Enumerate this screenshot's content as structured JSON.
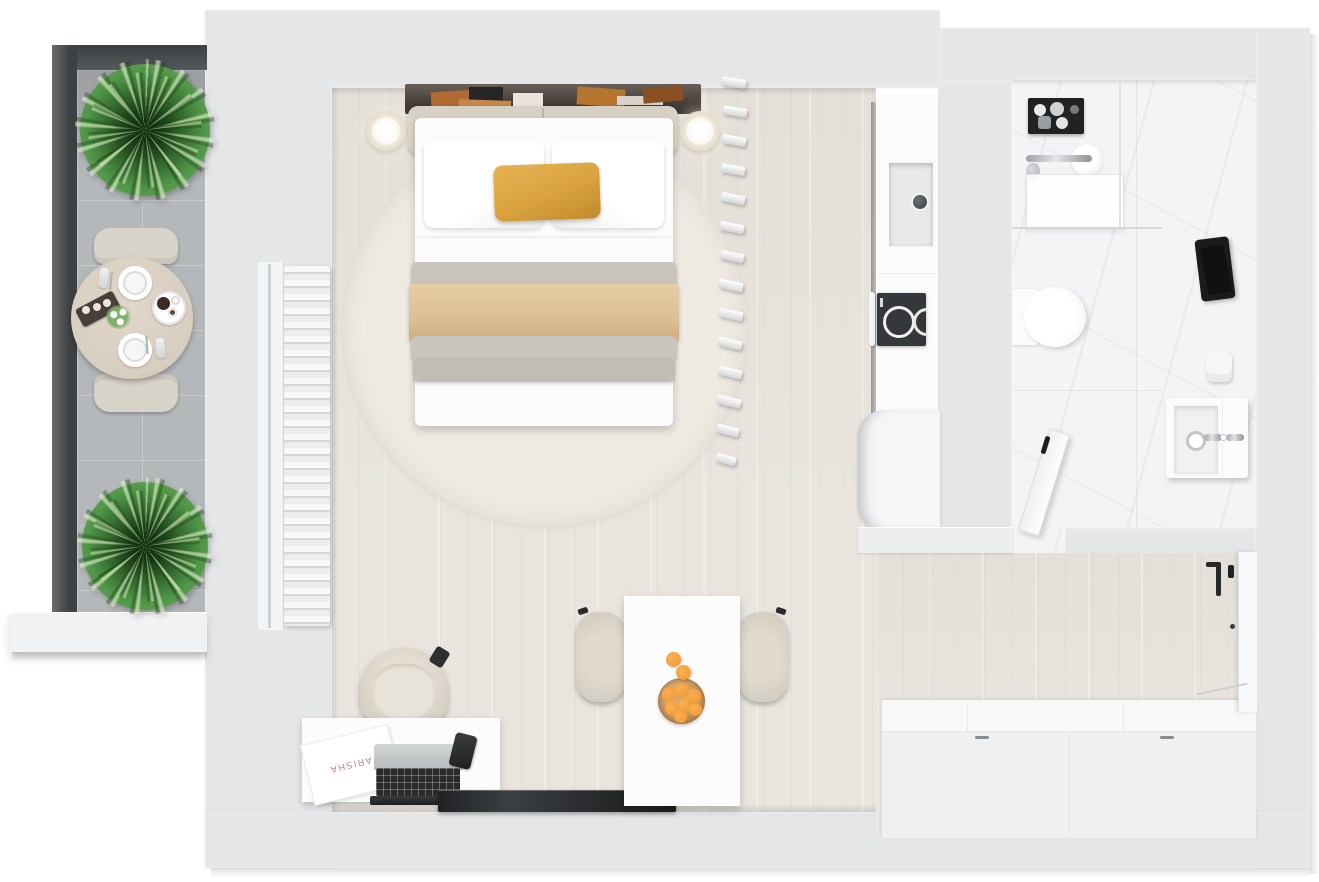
{
  "scene": {
    "type": "3d-floor-plan-top-view",
    "subject": "Studio apartment render: balcony with dining set and plants, bedroom-living room, kitchenette, marble bathroom, entry hall"
  },
  "labels": {
    "desk_paper": "ARISHA"
  },
  "rooms": [
    {
      "id": "balcony"
    },
    {
      "id": "main-room"
    },
    {
      "id": "kitchen"
    },
    {
      "id": "bathroom"
    },
    {
      "id": "entry-hall"
    }
  ],
  "colors": {
    "wall": "#e5e6e8",
    "wood_floor": "#e9e5de",
    "marble": "#f4f4f6",
    "balcony_tile": "#b5b8ba",
    "balcony_rail": "#44484b",
    "rug": "#eeeae2",
    "bed_white": "#fbfbfb",
    "pillow_accent": "#d9a23f",
    "throw_beige": "#ddc096",
    "blanket_gray": "#cac5bc",
    "headboard": "#d7d1c5",
    "chair_beige": "#d9d4ca",
    "table_wood": "#d8cec0",
    "orange_fruit": "#f2952d",
    "bowl_wood": "#bf8a52",
    "cooktop_black": "#35383a",
    "tv_black": "#2c2e30",
    "towel_black": "#1a1b1d",
    "counter_white": "#fafbfb",
    "plant_green": "#4f9347"
  }
}
